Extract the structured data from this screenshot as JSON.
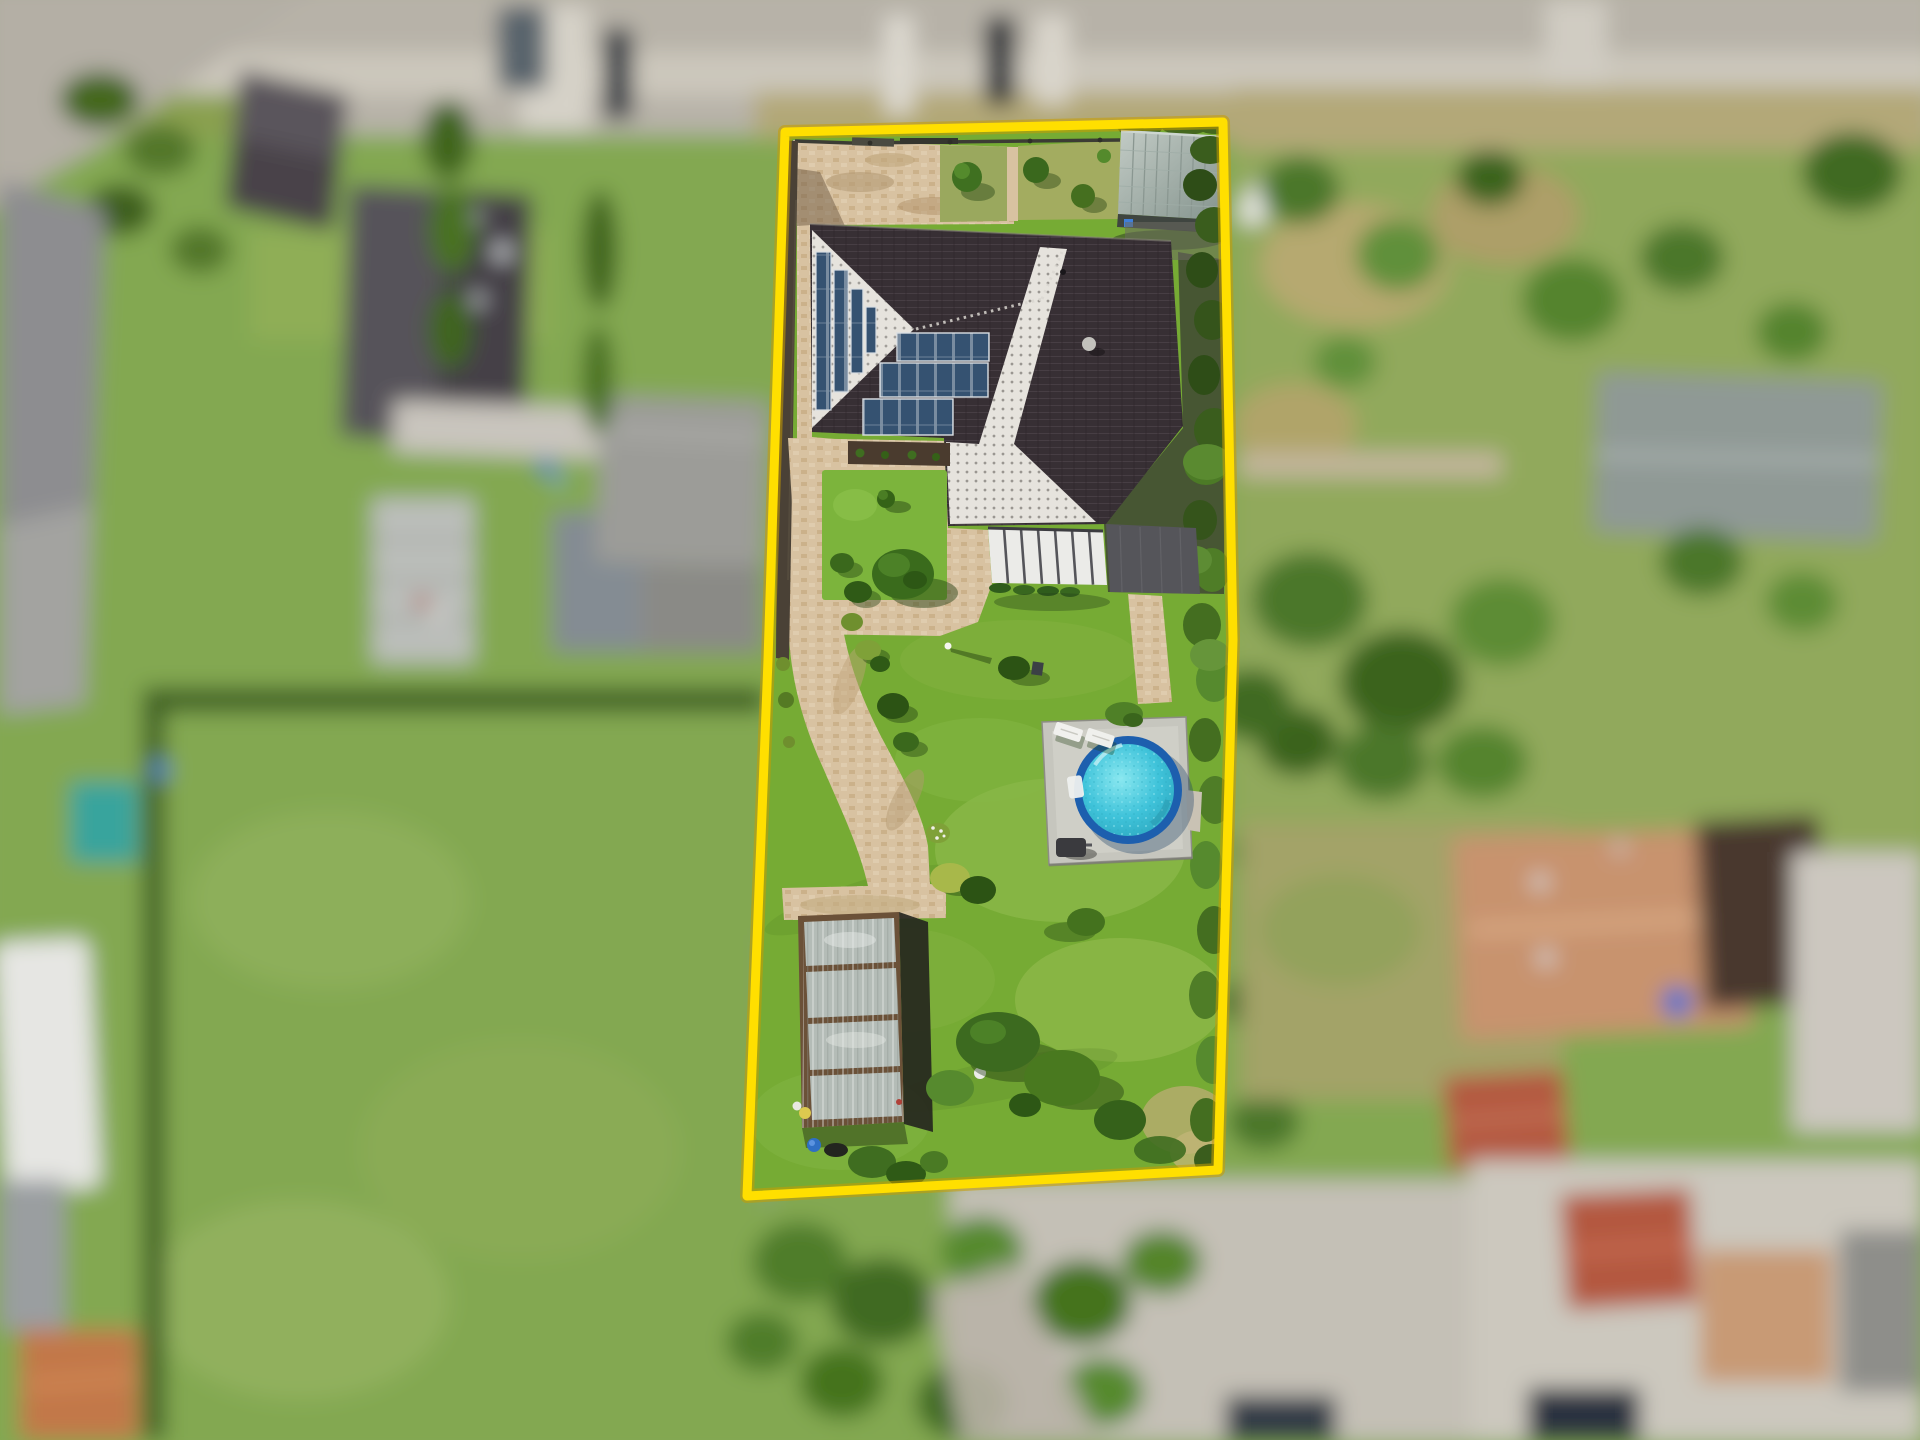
{
  "image": {
    "kind": "aerial drone photograph",
    "subject": "suburban residential plot outlined with a yellow property boundary",
    "effect": "tilt-shift: sharp highlighted parcel, blurred neighbourhood",
    "width_px": 1920,
    "height_px": 1440
  },
  "colors": {
    "boundary": "#ffdf00",
    "boundary_under": "#c99c00",
    "lawn": "#76ab34",
    "lawn_light": "#97c157",
    "path": "#d8c2a1",
    "roof_dark": "#372f34",
    "roof_white": "#e6e3dd",
    "solar_panel": "#3b5878",
    "shed_roof": "#a9b5af",
    "pool_rim": "#1d5fae",
    "pool_water": "#3fc3da",
    "pool_deck": "#c6c6be",
    "greenhouse_glass": "#b4bcb7",
    "greenhouse_frame": "#6b5138",
    "hedge": "#4f7d27",
    "terrace_dark": "#55555a",
    "awning_white": "#ebebe8",
    "road": "#b7b2a8",
    "verge": "#b3a878",
    "field": "#83a851",
    "neighbor_roof_tan": "#c8936e",
    "neighbor_roof_red": "#b4593f",
    "neighbor_roof_dark": "#56525a"
  },
  "parcel": {
    "boundary_points": "785,132 1223,122 1233,640 1218,1170 747,1196 768,660",
    "features": [
      {
        "name": "driveway",
        "desc": "beige paved driveway at street side"
      },
      {
        "name": "house",
        "desc": "single family house with dark hip roof"
      },
      {
        "name": "solar-panels",
        "desc": "photovoltaic arrays on west gable and south roof"
      },
      {
        "name": "satellite-dish",
        "desc": "dish antenna near the ridge"
      },
      {
        "name": "garden-shed",
        "desc": "metal roofed shed in the north east corner"
      },
      {
        "name": "patio-awning",
        "desc": "white louvered patio cover on the south side"
      },
      {
        "name": "garden-path",
        "desc": "winding paver path along the west side"
      },
      {
        "name": "lawn",
        "desc": "large sunlit garden lawn"
      },
      {
        "name": "pool",
        "desc": "round above ground pool on a grey terrace pad"
      },
      {
        "name": "pool-loungers",
        "desc": "two white sun loungers"
      },
      {
        "name": "greenhouse",
        "desc": "glass greenhouse in the south west corner"
      },
      {
        "name": "hedge",
        "desc": "clipped hedge along the east boundary"
      },
      {
        "name": "trees",
        "desc": "ornamental shrubs and fruit trees"
      }
    ]
  },
  "surroundings": {
    "top": "street with sidewalk, grass verge and two parked cars",
    "left": "neighbouring houses, garages and a long meadow",
    "right": "mature gardens, garden house and tan roofed residence",
    "bottom": "shrubs, driveways and further rooftops"
  }
}
